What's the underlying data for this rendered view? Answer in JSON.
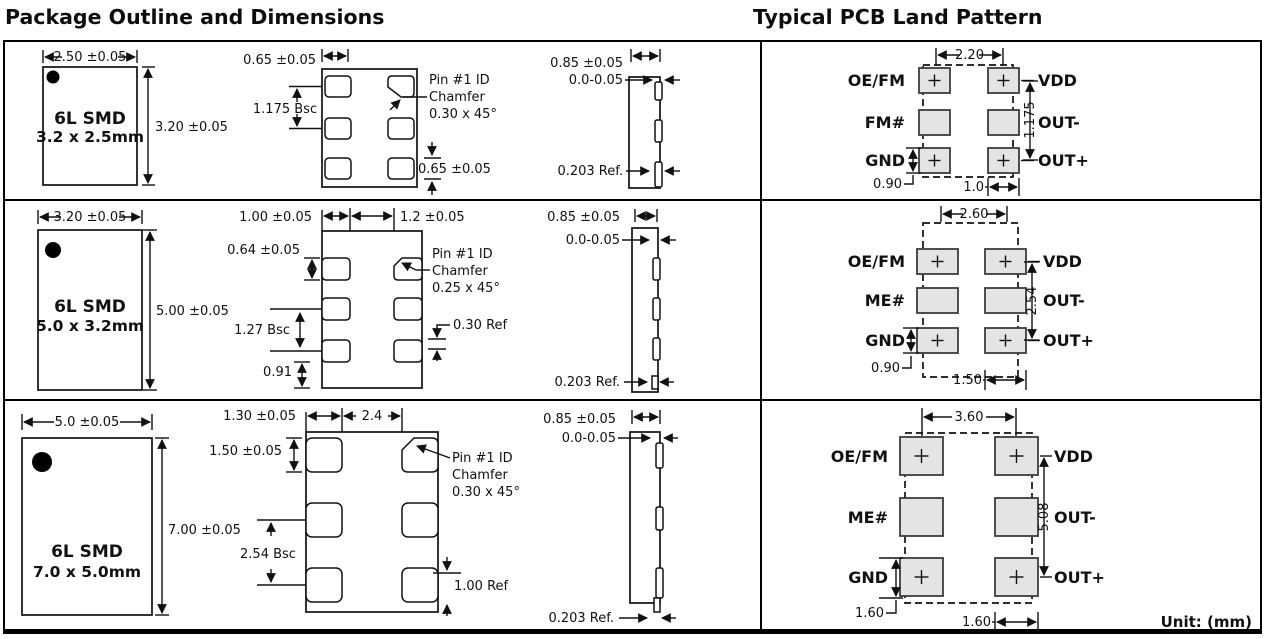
{
  "titles": {
    "left": "Package Outline and Dimensions",
    "right": "Typical PCB Land Pattern"
  },
  "unit_note": "Unit:  (mm)",
  "rows": [
    {
      "outline": {
        "line1": "6L SMD",
        "line2": "3.2 x 2.5mm",
        "width": "2.50 ±0.05",
        "height": "3.20 ±0.05"
      },
      "top_view": {
        "pad_width": "0.65 ±0.05",
        "pitch": "1.175 Bsc",
        "pad_height": "0.65 ±0.05",
        "pin1": [
          "Pin #1 ID",
          "Chamfer",
          "0.30 x 45°"
        ]
      },
      "side_view": {
        "height": "0.85 ±0.05",
        "standoff": "0.0-0.05",
        "lead": "0.203 Ref."
      },
      "land": {
        "left_labels": [
          "OE/FM",
          "FM#",
          "GND"
        ],
        "right_labels": [
          "VDD",
          "OUT-",
          "OUT+"
        ],
        "width": "2.20",
        "height": "1.175",
        "pad_height": "0.90",
        "pad_width": "1.0"
      }
    },
    {
      "outline": {
        "line1": "6L SMD",
        "line2": "5.0 x 3.2mm",
        "width": "3.20 ±0.05",
        "height": "5.00 ±0.05"
      },
      "top_view": {
        "pad_width": "1.00 ±0.05",
        "gap": "1.2 ±0.05",
        "pad_height": "0.64 ±0.05",
        "pitch": "1.27 Bsc",
        "bottom_offset": "0.91",
        "corner_ref": "0.30 Ref",
        "pin1": [
          "Pin #1 ID",
          "Chamfer",
          "0.25 x 45°"
        ]
      },
      "side_view": {
        "height": "0.85 ±0.05",
        "standoff": "0.0-0.05",
        "lead": "0.203 Ref."
      },
      "land": {
        "left_labels": [
          "OE/FM",
          "ME#",
          "GND"
        ],
        "right_labels": [
          "VDD",
          "OUT-",
          "OUT+"
        ],
        "width": "2.60",
        "height": "2.54",
        "pad_height": "0.90",
        "pad_width": "1.50"
      }
    },
    {
      "outline": {
        "line1": "6L SMD",
        "line2": "7.0 x 5.0mm",
        "width": "5.0 ±0.05",
        "height": "7.00 ±0.05"
      },
      "top_view": {
        "pad_width": "1.30 ±0.05",
        "gap": "2.4",
        "pad_height": "1.50 ±0.05",
        "pitch": "2.54 Bsc",
        "corner_ref": "1.00 Ref",
        "pin1": [
          "Pin #1 ID",
          "Chamfer",
          "0.30 x 45°"
        ]
      },
      "side_view": {
        "height": "0.85 ±0.05",
        "standoff": "0.0-0.05",
        "lead": "0.203 Ref."
      },
      "land": {
        "left_labels": [
          "OE/FM",
          "ME#",
          "GND"
        ],
        "right_labels": [
          "VDD",
          "OUT-",
          "OUT+"
        ],
        "width": "3.60",
        "height": "5.08",
        "pad_height": "1.60",
        "pad_width": "1.60"
      }
    }
  ]
}
